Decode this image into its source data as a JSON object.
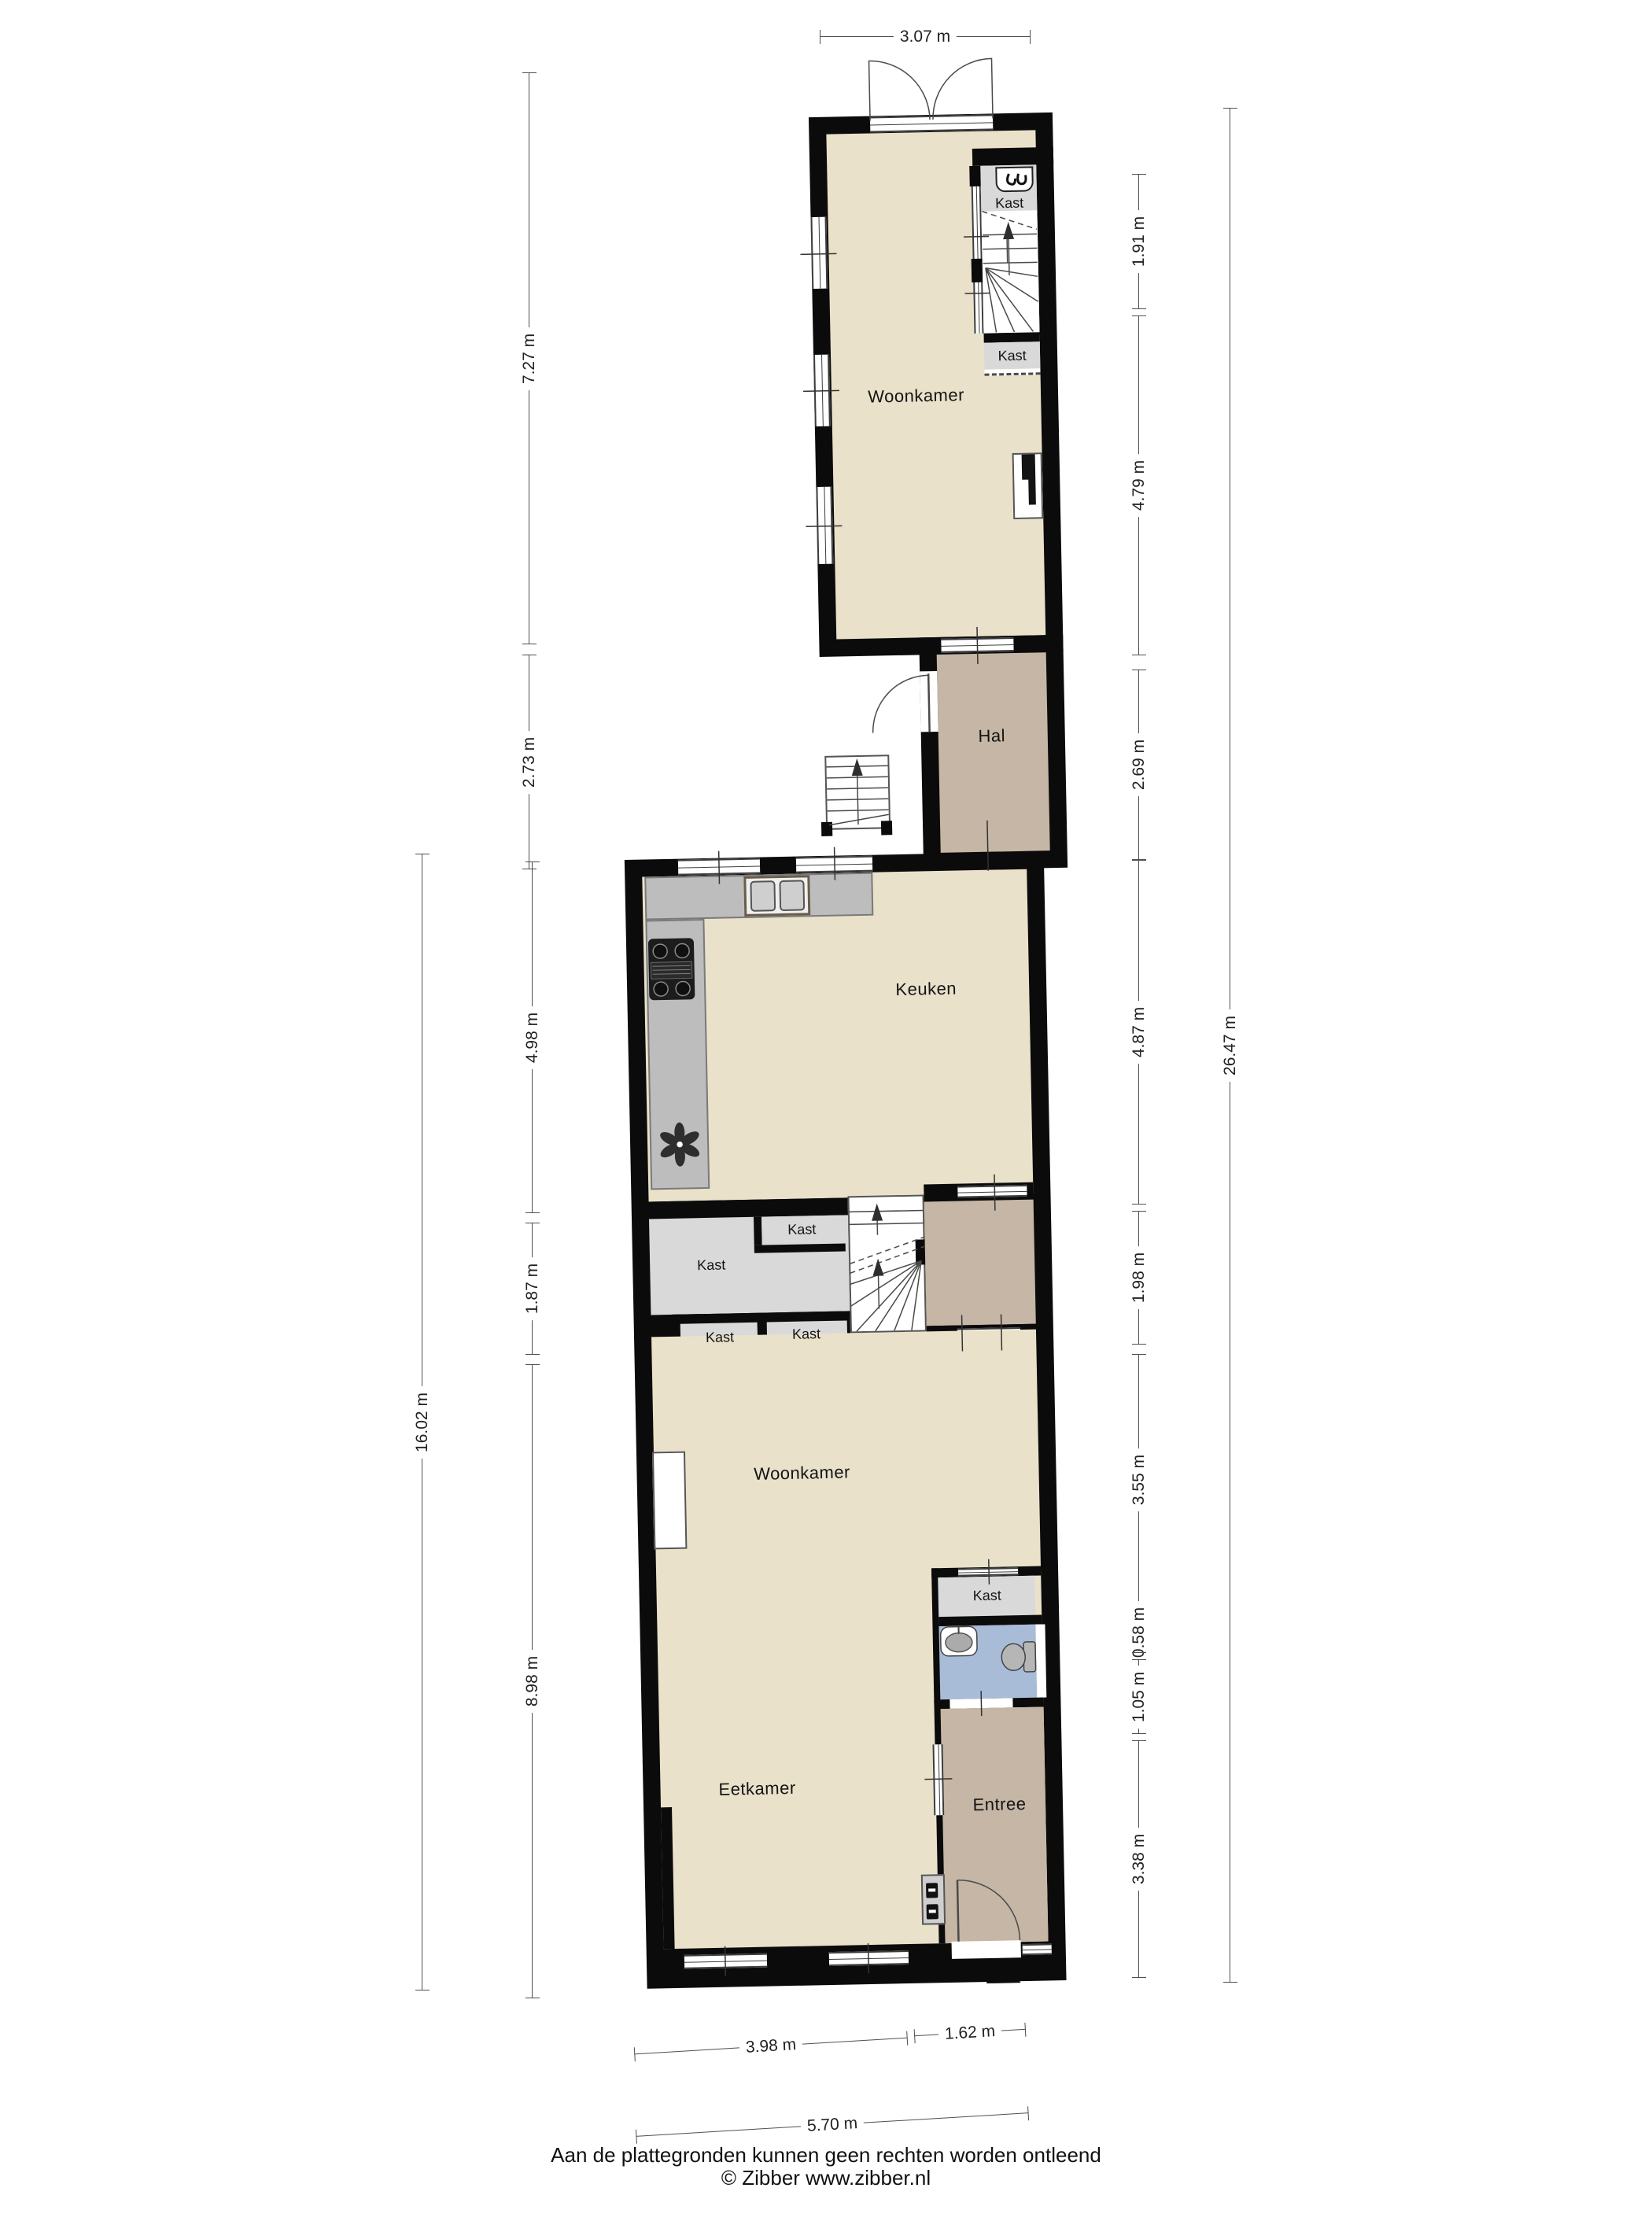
{
  "plan_title": "Begane grond plattegrond",
  "rooms": {
    "woonkamer_boven": "Woonkamer",
    "hal": "Hal",
    "keuken": "Keuken",
    "woonkamer": "Woonkamer",
    "eetkamer": "Eetkamer",
    "entree": "Entree"
  },
  "closets": {
    "trap_boven": "Kast",
    "onder_trap": "Kast",
    "keuken_klein": "Kast",
    "keuken_groot": "Kast",
    "onder_links": "Kast",
    "onder_rechts": "Kast",
    "bij_toilet": "Kast"
  },
  "dims": {
    "top": "3.07 m",
    "left": {
      "a": "7.27 m",
      "b": "2.73 m",
      "total": "16.02 m",
      "c": "4.98 m",
      "d": "1.87 m",
      "e": "8.98 m"
    },
    "right": {
      "a": "1.91 m",
      "b": "4.79 m",
      "c": "2.69 m",
      "d": "4.87 m",
      "e": "1.98 m",
      "f": "3.55 m",
      "g": "0.58 m",
      "h": "1.05 m",
      "i": "3.38 m",
      "total": "26.47 m"
    },
    "bottom": {
      "a": "3.98 m",
      "b": "1.62 m",
      "total": "5.70 m"
    }
  },
  "icons": {
    "coat_hook": "coat-hook-icon",
    "ventilation_fan": "ventilation-fan-icon",
    "stairs_up_arrow": "stairs-up-arrow",
    "entrance_marker": "entrance-triangle-marker",
    "sink": "kitchen-sink",
    "stove": "stove-cooktop",
    "toilet": "toilet",
    "washbasin": "washbasin",
    "meter_box": "meter-box"
  },
  "colors": {
    "beige": "#e9e1ca",
    "tan": "#c5b6a5",
    "grey": "#d9d9d9",
    "blue": "#a8bcd8",
    "counter": "#bdbdbd",
    "wall": "#0b0b0b"
  },
  "footer": {
    "disclaimer": "Aan de plattegronden kunnen geen rechten worden ontleend",
    "copyright": "© Zibber www.zibber.nl"
  }
}
